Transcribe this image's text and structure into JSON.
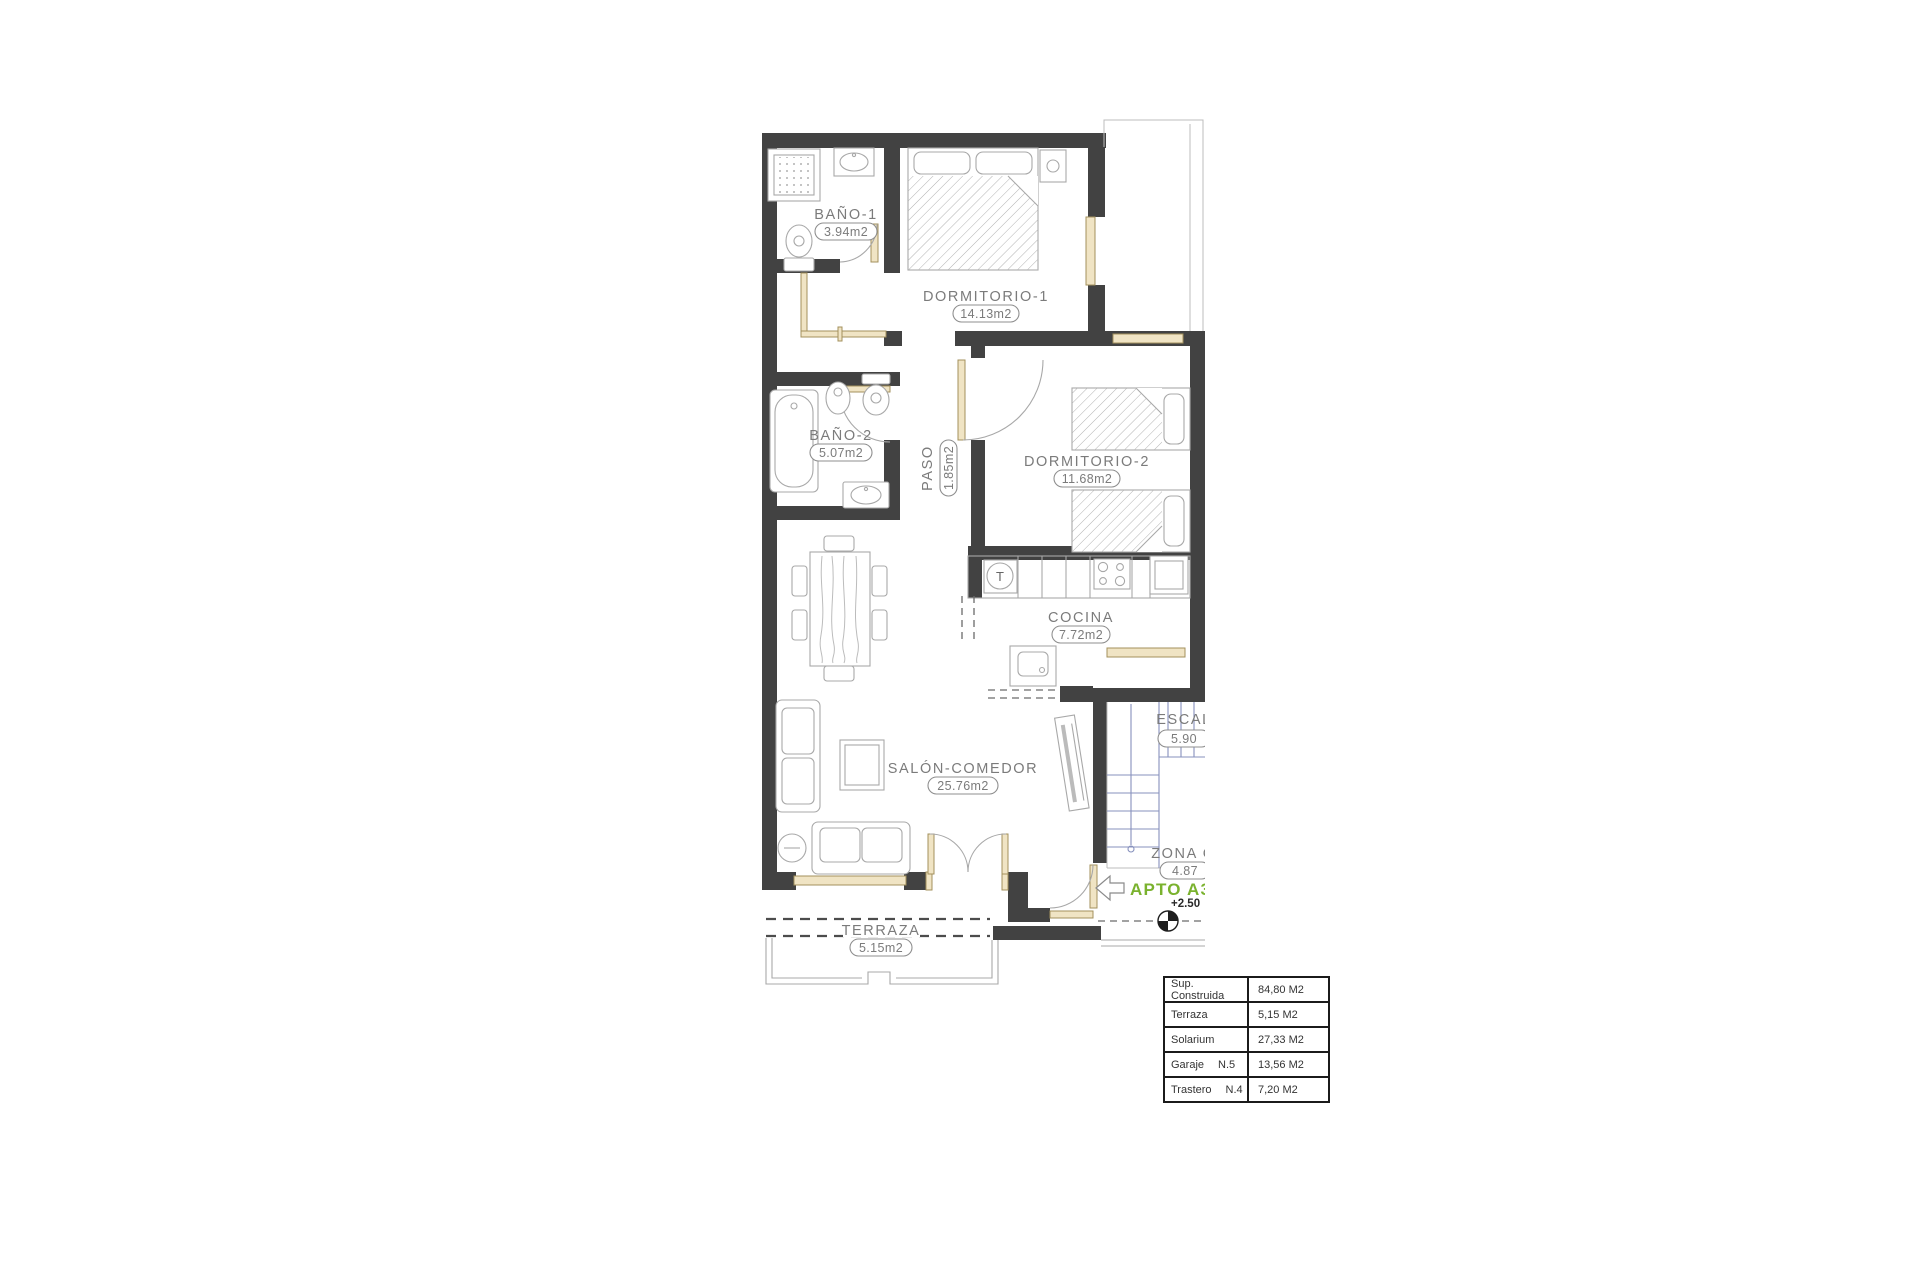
{
  "plan": {
    "rooms": {
      "bano1": {
        "name": "BAÑO-1",
        "area": "3.94m2"
      },
      "dormitorio1": {
        "name": "DORMITORIO-1",
        "area": "14.13m2"
      },
      "bano2": {
        "name": "BAÑO-2",
        "area": "5.07m2"
      },
      "paso": {
        "name": "PASO",
        "area": "1.85m2"
      },
      "dormitorio2": {
        "name": "DORMITORIO-2",
        "area": "11.68m2"
      },
      "cocina": {
        "name": "COCINA",
        "area": "7.72m2"
      },
      "salon": {
        "name": "SALÓN-COMEDOR",
        "area": "25.76m2"
      },
      "terraza": {
        "name": "TERRAZA",
        "area": "5.15m2"
      },
      "escalera": {
        "name": "ESCAL",
        "area": "5.90"
      },
      "zona_comun": {
        "name": "ZONA C",
        "area": "4.87"
      }
    },
    "annotations": {
      "apartment_label": "APTO A3",
      "level_mark": "+2.50",
      "washer_letter": "T"
    },
    "colors": {
      "wall": "#424242",
      "line_gray": "#a8a8a8",
      "carpentry_tan": "#f0e4c4",
      "stairs_blue": "#8791bd",
      "accent_green": "#7ab22e",
      "label_gray": "#7b7b7b"
    }
  },
  "summary_table": {
    "rows": [
      {
        "label": "Sup. Construida",
        "unit": "",
        "value": "84,80 M2"
      },
      {
        "label": "Terraza",
        "unit": "",
        "value": "5,15 M2"
      },
      {
        "label": "Solarium",
        "unit": "",
        "value": "27,33 M2"
      },
      {
        "label": "Garaje",
        "unit": "N.5",
        "value": "13,56 M2"
      },
      {
        "label": "Trastero",
        "unit": "N.4",
        "value": "7,20 M2"
      }
    ]
  }
}
